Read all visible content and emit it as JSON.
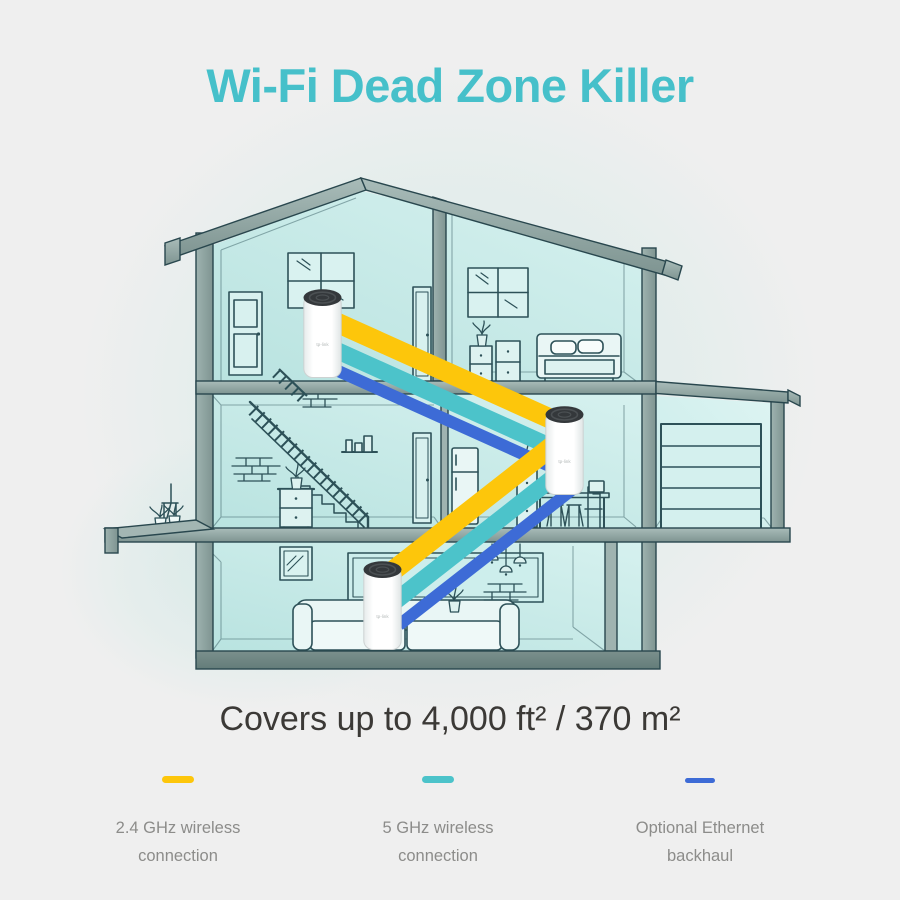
{
  "title": {
    "text": "Wi-Fi Dead Zone Killer",
    "color": "#46c0ca"
  },
  "coverage": {
    "text": "Covers up to 4,000 ft² / 370 m²",
    "color": "#3b3936"
  },
  "legend": {
    "text_color": "#8c8c8a",
    "items": [
      {
        "name": "2.4ghz-wireless",
        "lines": [
          "2.4 GHz wireless",
          "connection"
        ],
        "color": "#fdc60b"
      },
      {
        "name": "5ghz-wireless",
        "lines": [
          "5 GHz wireless",
          "connection"
        ],
        "color": "#4cc3ca"
      },
      {
        "name": "ethernet-backhaul",
        "lines": [
          "Optional Ethernet",
          "backhaul"
        ],
        "color": "#3d6bd6"
      }
    ]
  },
  "diagram": {
    "units": [
      {
        "label": "tp-link",
        "location": "attic"
      },
      {
        "label": "tp-link",
        "location": "dining-room"
      },
      {
        "label": "tp-link",
        "location": "living-room"
      }
    ],
    "bands": {
      "wireless_24ghz": "#fdc60b",
      "wireless_5ghz": "#4cc3ca",
      "ethernet": "#3d6bd6"
    }
  }
}
